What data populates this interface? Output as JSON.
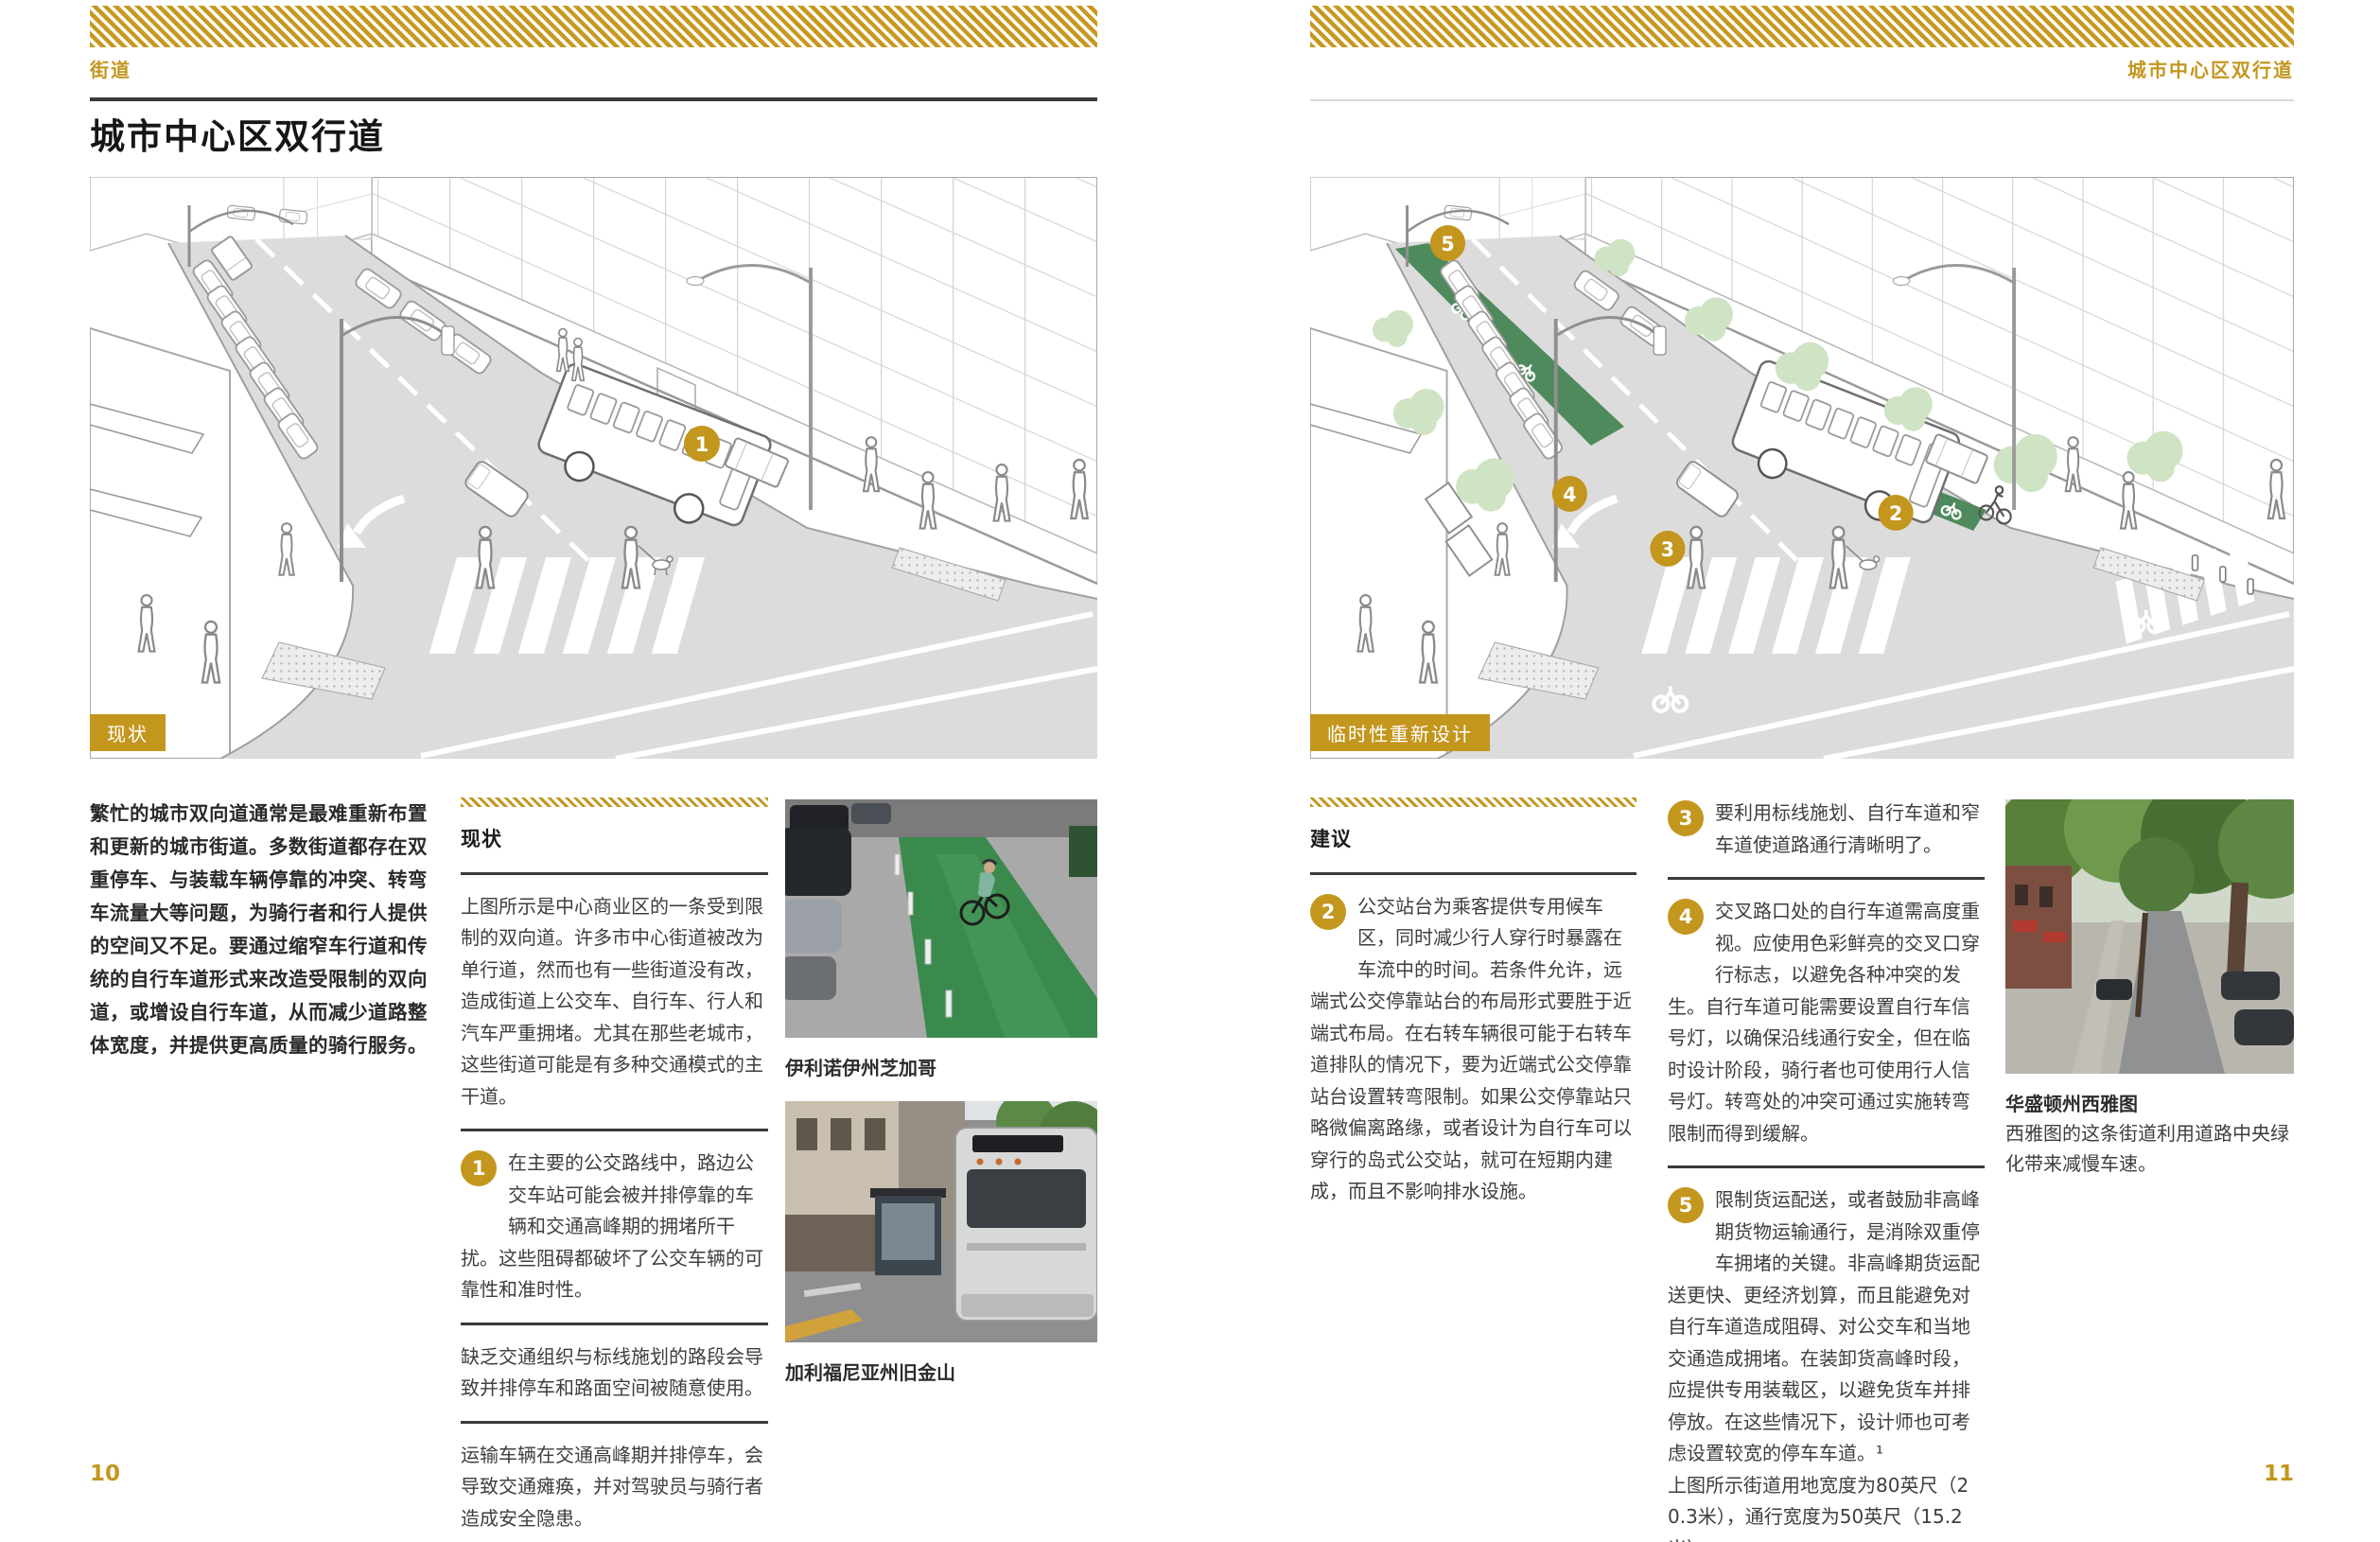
{
  "colors": {
    "accent_gold": "#C3961E",
    "bike_lane_green": "#4E8A5C",
    "tree_green": "#CFE4C4",
    "rule_dark": "#3A3A3A"
  },
  "page_left": {
    "eyebrow": "街道",
    "title": "城市中心区双行道",
    "illustration_label": "现状",
    "marker_1": "1",
    "intro": "繁忙的城市双向道通常是最难重新布置和更新的城市街道。多数街道都存在双重停车、与装载车辆停靠的冲突、转弯车流量大等问题，为骑行者和行人提供的空间又不足。要通过缩窄车行道和传统的自行车道形式来改造受限制的双向道，或增设自行车道，从而减少道路整体宽度，并提供更高质量的骑行服务。",
    "section": {
      "heading": "现状",
      "para1": "上图所示是中心商业区的一条受到限制的双向道。许多市中心街道被改为单行道，然而也有一些街道没有改，造成街道上公交车、自行车、行人和汽车严重拥堵。尤其在那些老城市，这些街道可能是有多种交通模式的主干道。",
      "item1_num": "1",
      "item1": "在主要的公交路线中，路边公交车站可能会被并排停靠的车辆和交通高峰期的拥堵所干扰。这些阻碍都破坏了公交车辆的可靠性和准时性。",
      "para2": "缺乏交通组织与标线施划的路段会导致并排停车和路面空间被随意使用。",
      "para3": "运输车辆在交通高峰期并排停车，会导致交通瘫痪，并对驾驶员与骑行者造成安全隐患。"
    },
    "photos": [
      {
        "caption": "伊利诺伊州芝加哥"
      },
      {
        "caption": "加利福尼亚州旧金山"
      }
    ],
    "page_number": "10"
  },
  "page_right": {
    "eyebrow": "城市中心区双行道",
    "illustration_label": "临时性重新设计",
    "markers": [
      "2",
      "3",
      "4",
      "5"
    ],
    "section": {
      "heading": "建议",
      "item2_num": "2",
      "item2": "公交站台为乘客提供专用候车区，同时减少行人穿行时暴露在车流中的时间。若条件允许，远端式公交停靠站台的布局形式要胜于近端式布局。在右转车辆很可能于右转车道排队的情况下，要为近端式公交停靠站台设置转弯限制。如果公交停靠站只略微偏离路缘，或者设计为自行车可以穿行的岛式公交站，就可在短期内建成，而且不影响排水设施。",
      "item3_num": "3",
      "item3": "要利用标线施划、自行车道和窄车道使道路通行清晰明了。",
      "item4_num": "4",
      "item4": "交叉路口处的自行车道需高度重视。应使用色彩鲜亮的交叉口穿行标志，以避免各种冲突的发生。自行车道可能需要设置自行车信号灯，以确保沿线通行安全，但在临时设计阶段，骑行者也可使用行人信号灯。转弯处的冲突可通过实施转弯限制而得到缓解。",
      "item5_num": "5",
      "item5": "限制货运配送，或者鼓励非高峰期货物运输通行，是消除双重停车拥堵的关键。非高峰期货运配送更快、更经济划算，而且能避免对自行车道造成阻碍、对公交车和当地交通造成拥堵。在装卸货高峰时段，应提供专用装载区，以避免货车并排停放。在这些情况下，设计师也可考虑设置较宽的停车车道。¹",
      "closing": "上图所示街道用地宽度为80英尺（20.3米），通行宽度为50英尺（15.2米）。"
    },
    "photo": {
      "caption": "华盛顿州西雅图",
      "description": "西雅图的这条街道利用道路中央绿化带来减慢车速。"
    },
    "page_number": "11"
  }
}
